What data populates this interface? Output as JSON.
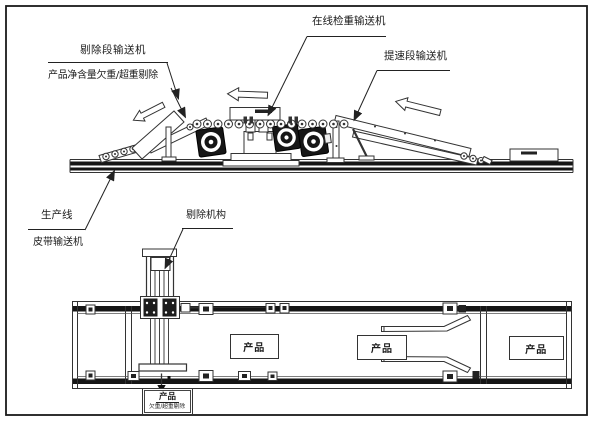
{
  "drawing": {
    "annotations": {
      "reject_section_conveyor": "剔除段输送机",
      "reject_description": "产品净含量欠重/超重剔除",
      "checkweigher_conveyor": "在线检重输送机",
      "speedup_section_conveyor": "提速段输送机",
      "production_line_line1": "生产线",
      "production_line_line2": "皮带输送机",
      "reject_mechanism": "剔除机构"
    },
    "product_label": "产品",
    "reject_output": {
      "title": "产品",
      "subtitle": "欠重/超重剔除"
    },
    "colors": {
      "line": "#333333",
      "dark_fill": "#161616",
      "background": "#ffffff"
    }
  }
}
